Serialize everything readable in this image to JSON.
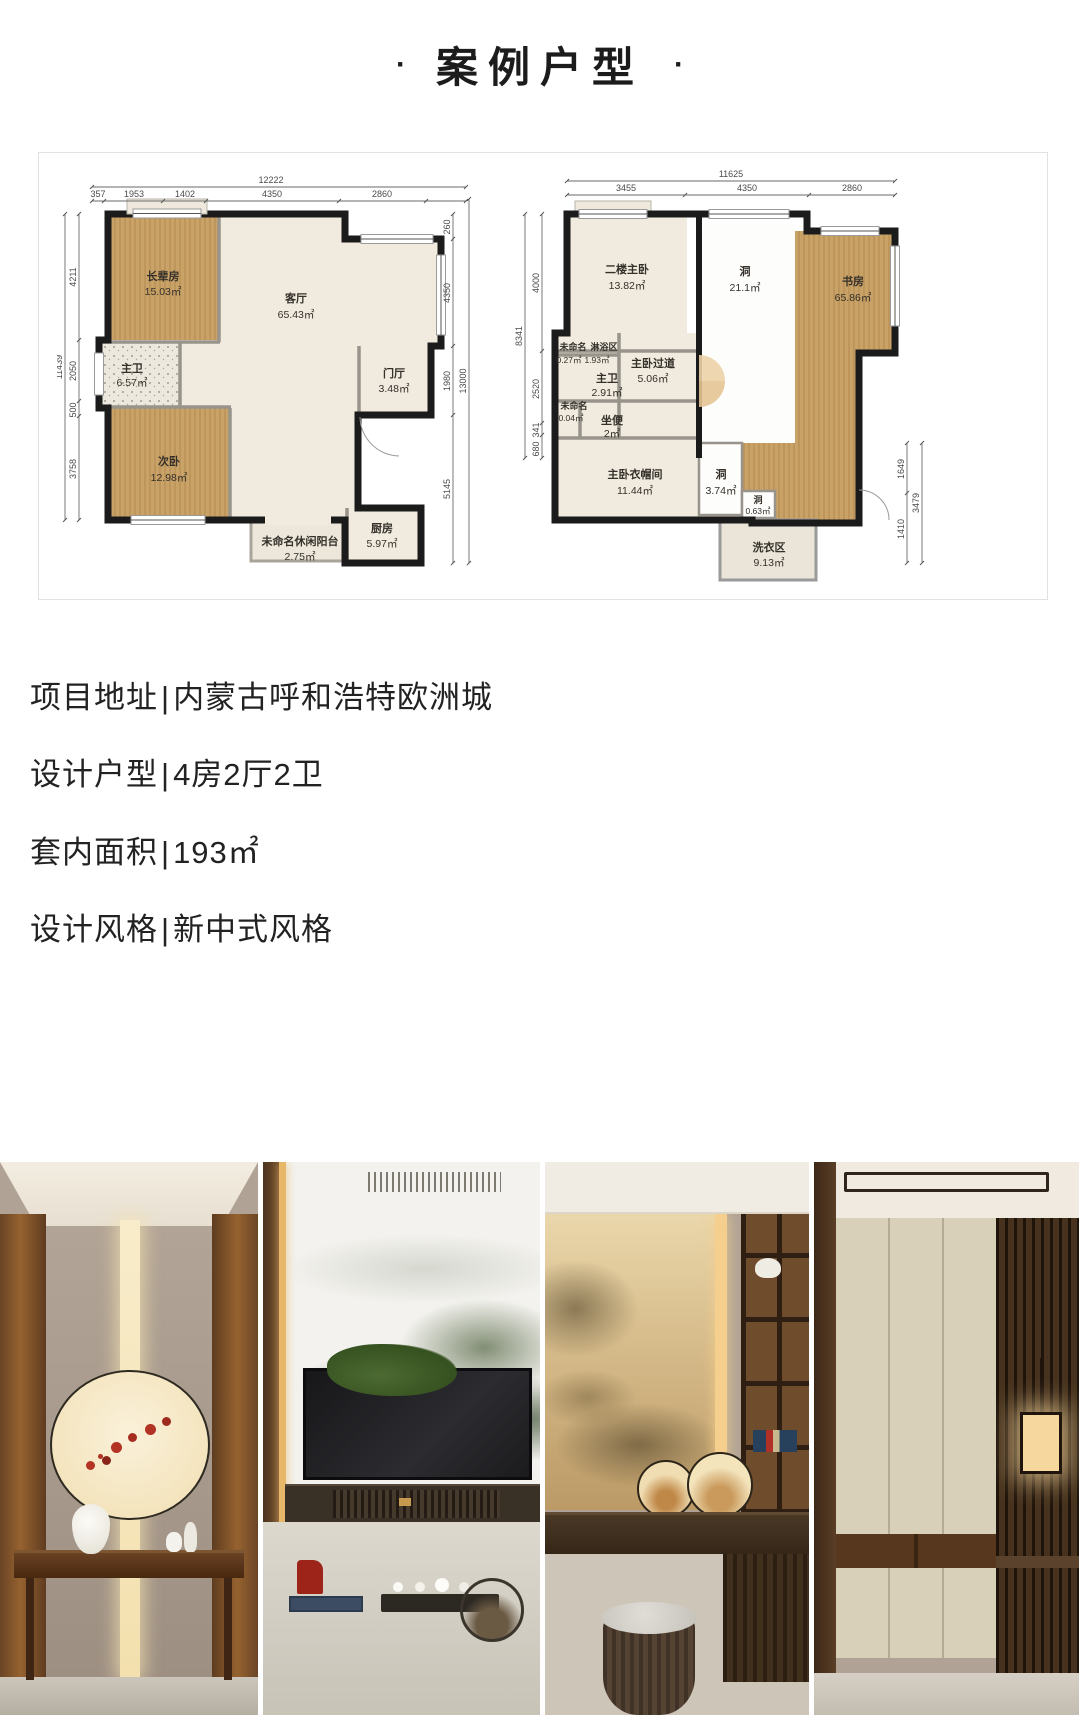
{
  "page": {
    "title_dot": "·",
    "title": "案例户型"
  },
  "info": {
    "sep": "|",
    "lines": [
      {
        "label": "项目地址",
        "value": "内蒙古呼和浩特欧洲城"
      },
      {
        "label": "设计户型",
        "value": "4房2厅2卫"
      },
      {
        "label": "套内面积",
        "value": "193㎡"
      },
      {
        "label": "设计风格",
        "value": "新中式风格"
      }
    ]
  },
  "colors": {
    "wood_floor": "#c9a268",
    "cream_floor": "#f0ebde",
    "wall": "#1b1b1b",
    "accent_gold": "#e7b869"
  },
  "floor_plans": {
    "left": {
      "rooms": [
        {
          "name": "长辈房",
          "area": "15.03㎡"
        },
        {
          "name": "客厅",
          "area": "65.43㎡"
        },
        {
          "name": "主卫",
          "area": "6.57㎡"
        },
        {
          "name": "次卧",
          "area": "12.98㎡"
        },
        {
          "name": "门厅",
          "area": "3.48㎡"
        },
        {
          "name": "厨房",
          "area": "5.97㎡"
        },
        {
          "name": "未命名休闲阳台",
          "area": "2.75㎡"
        }
      ],
      "dims": {
        "top_total": "12222",
        "top_segments": [
          "357",
          "1953",
          "1402",
          "4350",
          "2860"
        ],
        "left": [
          "4211",
          "2050",
          "500",
          "3758"
        ],
        "left_total": "11439",
        "right": [
          "260",
          "4350",
          "1980",
          "5145"
        ],
        "right_total": "13000"
      }
    },
    "right": {
      "rooms": [
        {
          "name": "二楼主卧",
          "area": "13.82㎡"
        },
        {
          "name": "洞",
          "area": "21.1㎡"
        },
        {
          "name": "书房",
          "area": "65.86㎡"
        },
        {
          "name": "未命名",
          "area": "0.27㎡"
        },
        {
          "name": "淋浴区",
          "area": "1.93㎡"
        },
        {
          "name": "主卫",
          "area": "2.91㎡"
        },
        {
          "name": "主卧过道",
          "area": "5.06㎡"
        },
        {
          "name": "未命名",
          "area": "0.04㎡"
        },
        {
          "name": "坐便",
          "area": "2㎡"
        },
        {
          "name": "主卧衣帽间",
          "area": "11.44㎡"
        },
        {
          "name": "洞",
          "area": "3.74㎡"
        },
        {
          "name": "洞",
          "area": "0.63㎡"
        },
        {
          "name": "洗衣区",
          "area": "9.13㎡"
        }
      ],
      "dims": {
        "top_total": "11625",
        "top_segments": [
          "3455",
          "4350",
          "2860"
        ],
        "left": [
          "4000",
          "2520",
          "341",
          "680"
        ],
        "left_total": "8341",
        "right": [
          "1649",
          "1410"
        ],
        "right_total": "3479"
      }
    }
  }
}
